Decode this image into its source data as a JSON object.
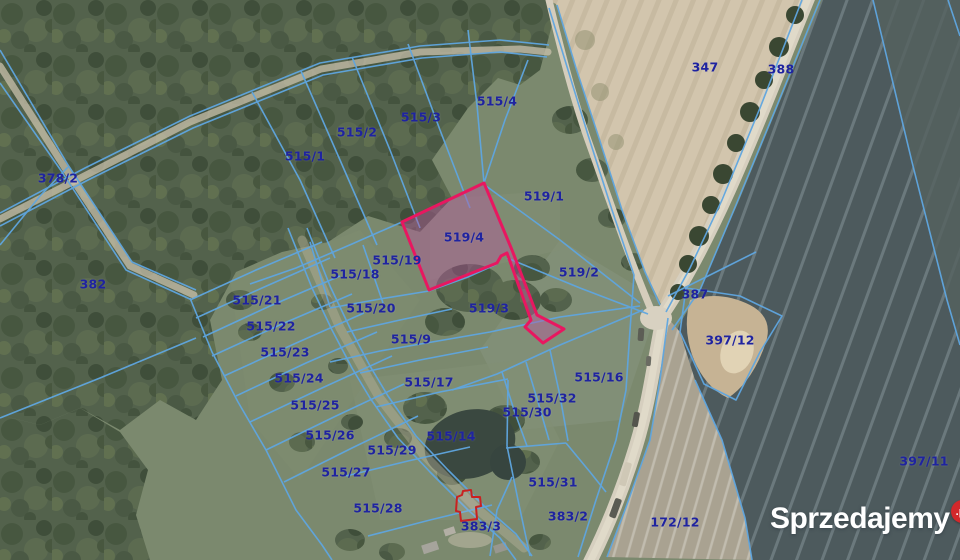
{
  "map": {
    "type": "cadastral-aerial-map",
    "highlighted_parcel": "519/4",
    "colors": {
      "boundary_line": "#5fa6e0",
      "parcel_label": "#1f23a0",
      "highlight_outline": "#e81760",
      "highlight_fill": "rgba(186,85,160,0.42)",
      "building_outline": "#c92121"
    },
    "parcels": [
      {
        "id": "378/2",
        "x": 58,
        "y": 178
      },
      {
        "id": "382",
        "x": 93,
        "y": 284
      },
      {
        "id": "515/1",
        "x": 305,
        "y": 156
      },
      {
        "id": "515/2",
        "x": 357,
        "y": 132
      },
      {
        "id": "515/3",
        "x": 421,
        "y": 117
      },
      {
        "id": "515/4",
        "x": 497,
        "y": 101
      },
      {
        "id": "347",
        "x": 705,
        "y": 67
      },
      {
        "id": "388",
        "x": 781,
        "y": 69
      },
      {
        "id": "519/1",
        "x": 544,
        "y": 196
      },
      {
        "id": "519/4",
        "x": 464,
        "y": 237
      },
      {
        "id": "515/19",
        "x": 397,
        "y": 260
      },
      {
        "id": "515/18",
        "x": 355,
        "y": 274
      },
      {
        "id": "519/2",
        "x": 579,
        "y": 272
      },
      {
        "id": "515/21",
        "x": 257,
        "y": 300
      },
      {
        "id": "515/20",
        "x": 371,
        "y": 308
      },
      {
        "id": "519/3",
        "x": 489,
        "y": 308
      },
      {
        "id": "387",
        "x": 695,
        "y": 294
      },
      {
        "id": "515/22",
        "x": 271,
        "y": 326
      },
      {
        "id": "515/9",
        "x": 411,
        "y": 339
      },
      {
        "id": "397/12",
        "x": 730,
        "y": 340
      },
      {
        "id": "515/23",
        "x": 285,
        "y": 352
      },
      {
        "id": "515/24",
        "x": 299,
        "y": 378
      },
      {
        "id": "515/17",
        "x": 429,
        "y": 382
      },
      {
        "id": "515/16",
        "x": 599,
        "y": 377
      },
      {
        "id": "515/25",
        "x": 315,
        "y": 405
      },
      {
        "id": "515/32",
        "x": 552,
        "y": 398
      },
      {
        "id": "515/30",
        "x": 527,
        "y": 412
      },
      {
        "id": "515/26",
        "x": 330,
        "y": 435
      },
      {
        "id": "515/14",
        "x": 451,
        "y": 436
      },
      {
        "id": "515/29",
        "x": 392,
        "y": 450
      },
      {
        "id": "397/11",
        "x": 924,
        "y": 461
      },
      {
        "id": "515/27",
        "x": 346,
        "y": 472
      },
      {
        "id": "515/31",
        "x": 553,
        "y": 482
      },
      {
        "id": "515/28",
        "x": 378,
        "y": 508
      },
      {
        "id": "383/3",
        "x": 481,
        "y": 526
      },
      {
        "id": "383/2",
        "x": 568,
        "y": 516
      },
      {
        "id": "172/12",
        "x": 675,
        "y": 522
      }
    ]
  },
  "watermark": {
    "name": "Sprzedajemy",
    "tld": ".pl",
    "badge_color": "#d3282b"
  }
}
